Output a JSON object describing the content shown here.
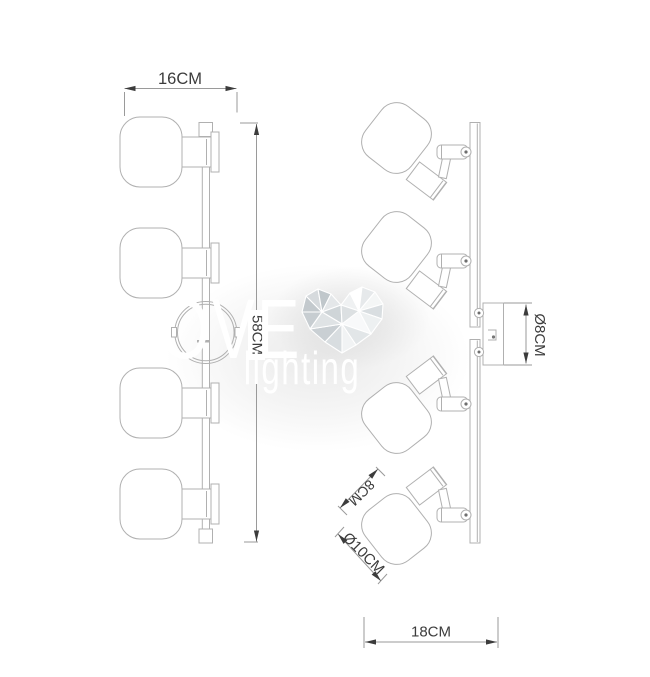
{
  "views": {
    "front": {
      "width_dim": "16CM",
      "height_dim": "58CM"
    },
    "side": {
      "canopy_dim": "Ø8CM",
      "shade_depth_dim": "8CM",
      "shade_diameter_dim": "Ø10CM",
      "depth_dim": "18CM"
    }
  },
  "watermark": {
    "brand": "LOVE",
    "brand_sub": "lighting",
    "heart_icon": "low-poly-heart-icon"
  },
  "colors": {
    "background": "#ffffff",
    "drawing_line": "#b0b0b0",
    "dimension_line": "#9a9a9a",
    "dimension_text": "#3c3c3c",
    "watermark_text": "#ffffff",
    "heart_gray": "#c9ced2"
  }
}
